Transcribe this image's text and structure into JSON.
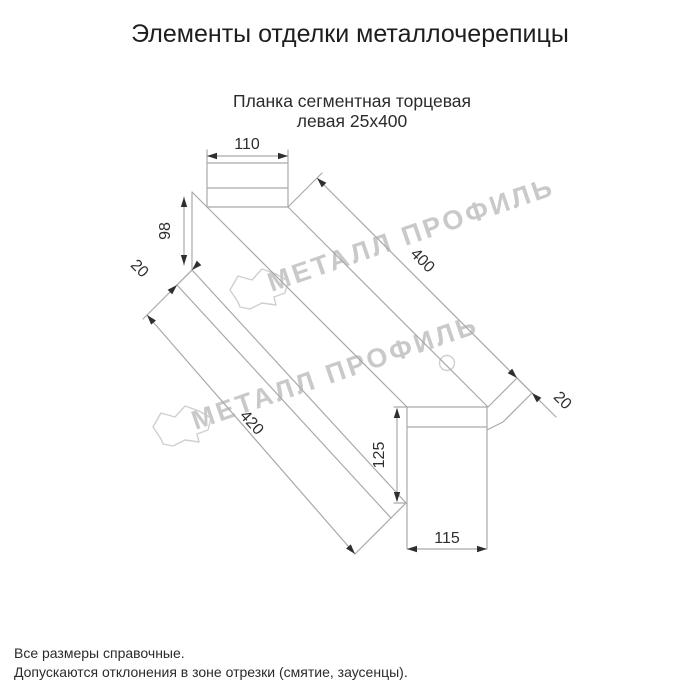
{
  "header": {
    "title": "Элементы отделки металлочерепицы"
  },
  "drawing": {
    "subtitle_line1": "Планка сегментная торцевая",
    "subtitle_line2": "левая 25х400",
    "dimensions": {
      "top_width": "110",
      "left_face_height": "98",
      "left_hem": "20",
      "top_length": "400",
      "bottom_length": "420",
      "end_face_height": "125",
      "end_face_width": "115",
      "right_hem": "20"
    }
  },
  "watermark": {
    "text": "МЕТАЛЛ ПРОФИЛЬ",
    "color": "#c9c9c9"
  },
  "footer": {
    "line1": "Все размеры справочные.",
    "line2": "Допускаются отклонения в зоне отрезки (смятие, заусенцы)."
  },
  "colors": {
    "line": "#a9a9a9",
    "dim_text": "#2f2f2f",
    "arrow": "#2f2f2f"
  }
}
